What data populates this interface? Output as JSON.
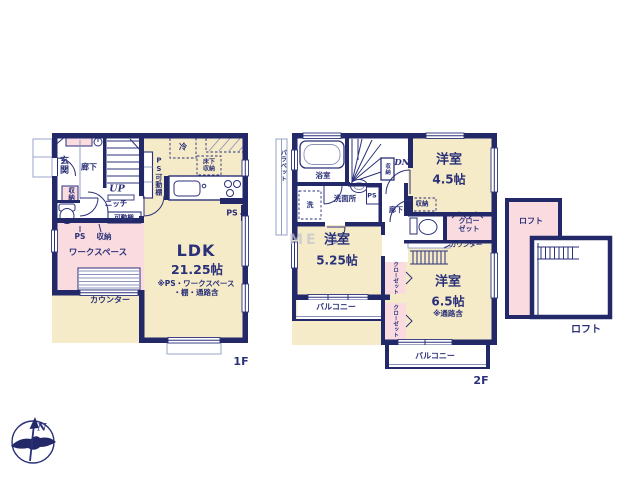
{
  "meta": {
    "watermark": "ME G",
    "compass_north": "N",
    "colors": {
      "wall": "#232968",
      "line": "#2b3178",
      "room_cream": "#f5ebc8",
      "room_pink": "#fadce0",
      "fixture": "#8b93bd",
      "porch": "#9aa3c7",
      "watermark": "#c3c6d1"
    }
  },
  "floor1": {
    "floor_label": "1F",
    "rooms": {
      "genkan": "玄関",
      "hallway": "廊下",
      "stairs_up": "UP",
      "ps_shelf": "PS可動棚",
      "niche": "ニッチ",
      "shelf": "可動棚",
      "closet_entry": "収納",
      "ps": "PS",
      "storage": "収納",
      "workspace": "ワークスペース",
      "counter": "カウンター",
      "fridge": "冷",
      "floor_storage": "床下収納",
      "ps_right": "PS",
      "ldk_name": "LDK",
      "ldk_size": "21.25帖",
      "ldk_note1": "※PS・ワークスペース",
      "ldk_note2": "・棚・通路含"
    }
  },
  "floor2": {
    "floor_label": "2F",
    "rooms": {
      "parapet": "パラペット",
      "bath": "浴室",
      "washer": "洗",
      "washroom": "洗面所",
      "ps": "PS",
      "stairs_down": "DN",
      "stair_storage": "収納",
      "room45_name": "洋室",
      "room45_size": "4.5帖",
      "hallway": "廊下",
      "storage": "収納",
      "closet_right": "クローゼット",
      "counter": "カウンター",
      "room525_name": "洋室",
      "room525_size": "5.25帖",
      "closet_mid1": "クローゼット",
      "closet_mid2": "クローゼット",
      "room65_name": "洋室",
      "room65_size": "6.5帖",
      "room65_note": "※通路含",
      "balcony_left": "バルコニー",
      "balcony_bottom": "バルコニー"
    }
  },
  "loft": {
    "label_inner": "ロフト",
    "label_outer": "ロフト"
  }
}
